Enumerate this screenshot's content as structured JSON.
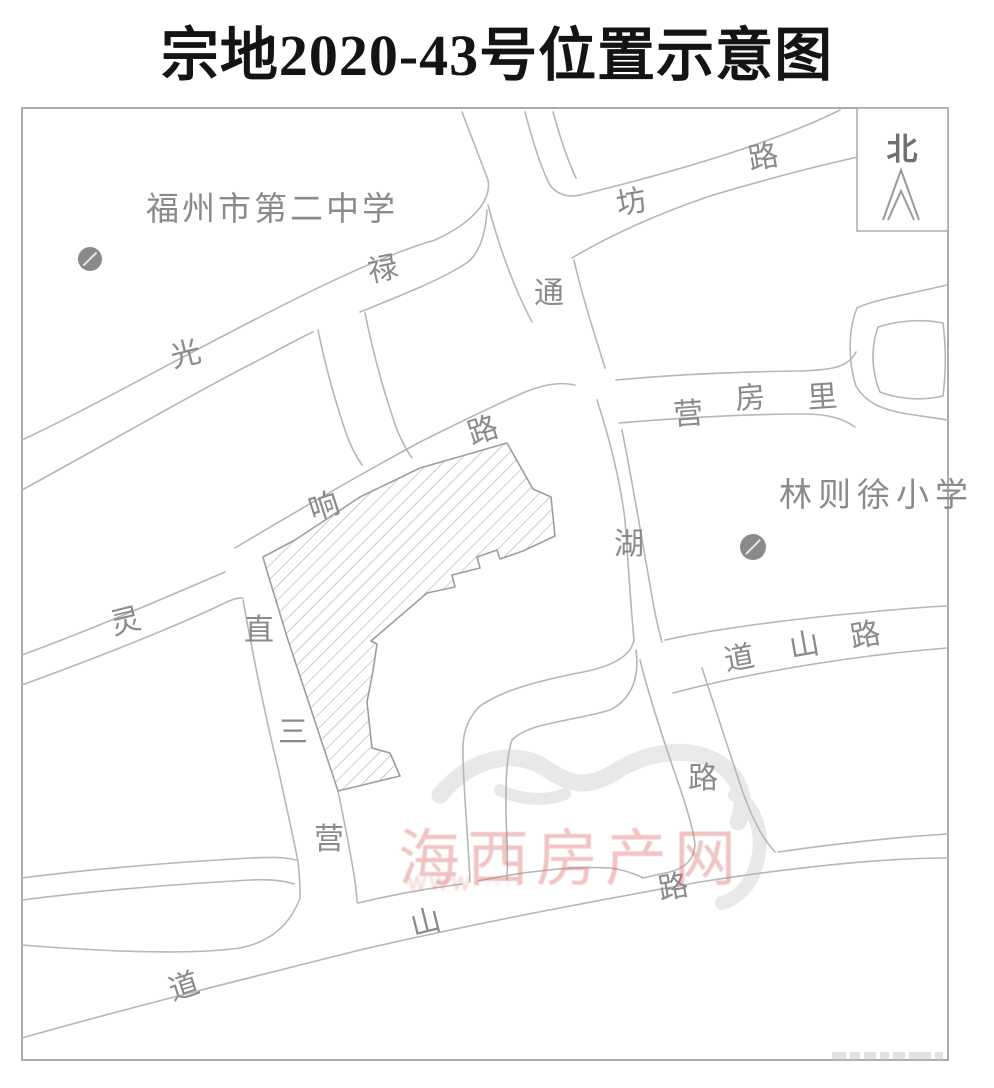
{
  "title": "宗地2020-43号位置示意图",
  "compass": {
    "label": "北"
  },
  "watermark": {
    "text": "海西房产网",
    "sub": "WWW·····",
    "color": "#de7070"
  },
  "pois": [
    {
      "name": "fuzhou-no2-middle-school",
      "label": "福州市第二中学",
      "x": 146,
      "y": 220,
      "ls": 3,
      "dot": {
        "cx": 90,
        "cy": 259,
        "r": 12
      }
    },
    {
      "name": "linzexu-primary-school",
      "label": "林则徐小学",
      "x": 779,
      "y": 506,
      "ls": 6,
      "dot": {
        "cx": 753,
        "cy": 547,
        "r": 13
      }
    }
  ],
  "road_labels": [
    {
      "ch": "光",
      "x": 188,
      "y": 364,
      "rot": -14
    },
    {
      "ch": "禄",
      "x": 385,
      "y": 279,
      "rot": -12
    },
    {
      "ch": "坊",
      "x": 633,
      "y": 212,
      "rot": -10
    },
    {
      "ch": "路",
      "x": 765,
      "y": 167,
      "rot": -10
    },
    {
      "ch": "通",
      "x": 549,
      "y": 303,
      "rot": 0
    },
    {
      "ch": "湖",
      "x": 629,
      "y": 554,
      "rot": 0
    },
    {
      "ch": "路",
      "x": 703,
      "y": 788,
      "rot": 0
    },
    {
      "ch": "响",
      "x": 327,
      "y": 516,
      "rot": -18
    },
    {
      "ch": "路",
      "x": 486,
      "y": 440,
      "rot": -18
    },
    {
      "ch": "灵",
      "x": 128,
      "y": 631,
      "rot": -14
    },
    {
      "ch": "直",
      "x": 259,
      "y": 640,
      "rot": 0
    },
    {
      "ch": "三",
      "x": 293,
      "y": 742,
      "rot": 0
    },
    {
      "ch": "营",
      "x": 329,
      "y": 849,
      "rot": 0
    },
    {
      "ch": "营",
      "x": 689,
      "y": 424,
      "rot": -4
    },
    {
      "ch": "房",
      "x": 751,
      "y": 408,
      "rot": -4
    },
    {
      "ch": "里",
      "x": 823,
      "y": 407,
      "rot": -4
    },
    {
      "ch": "道",
      "x": 741,
      "y": 668,
      "rot": -10
    },
    {
      "ch": "山",
      "x": 806,
      "y": 655,
      "rot": -10
    },
    {
      "ch": "路",
      "x": 867,
      "y": 645,
      "rot": -10
    },
    {
      "ch": "道",
      "x": 187,
      "y": 996,
      "rot": -18
    },
    {
      "ch": "山",
      "x": 428,
      "y": 932,
      "rot": -14
    },
    {
      "ch": "路",
      "x": 675,
      "y": 897,
      "rot": -10
    }
  ]
}
